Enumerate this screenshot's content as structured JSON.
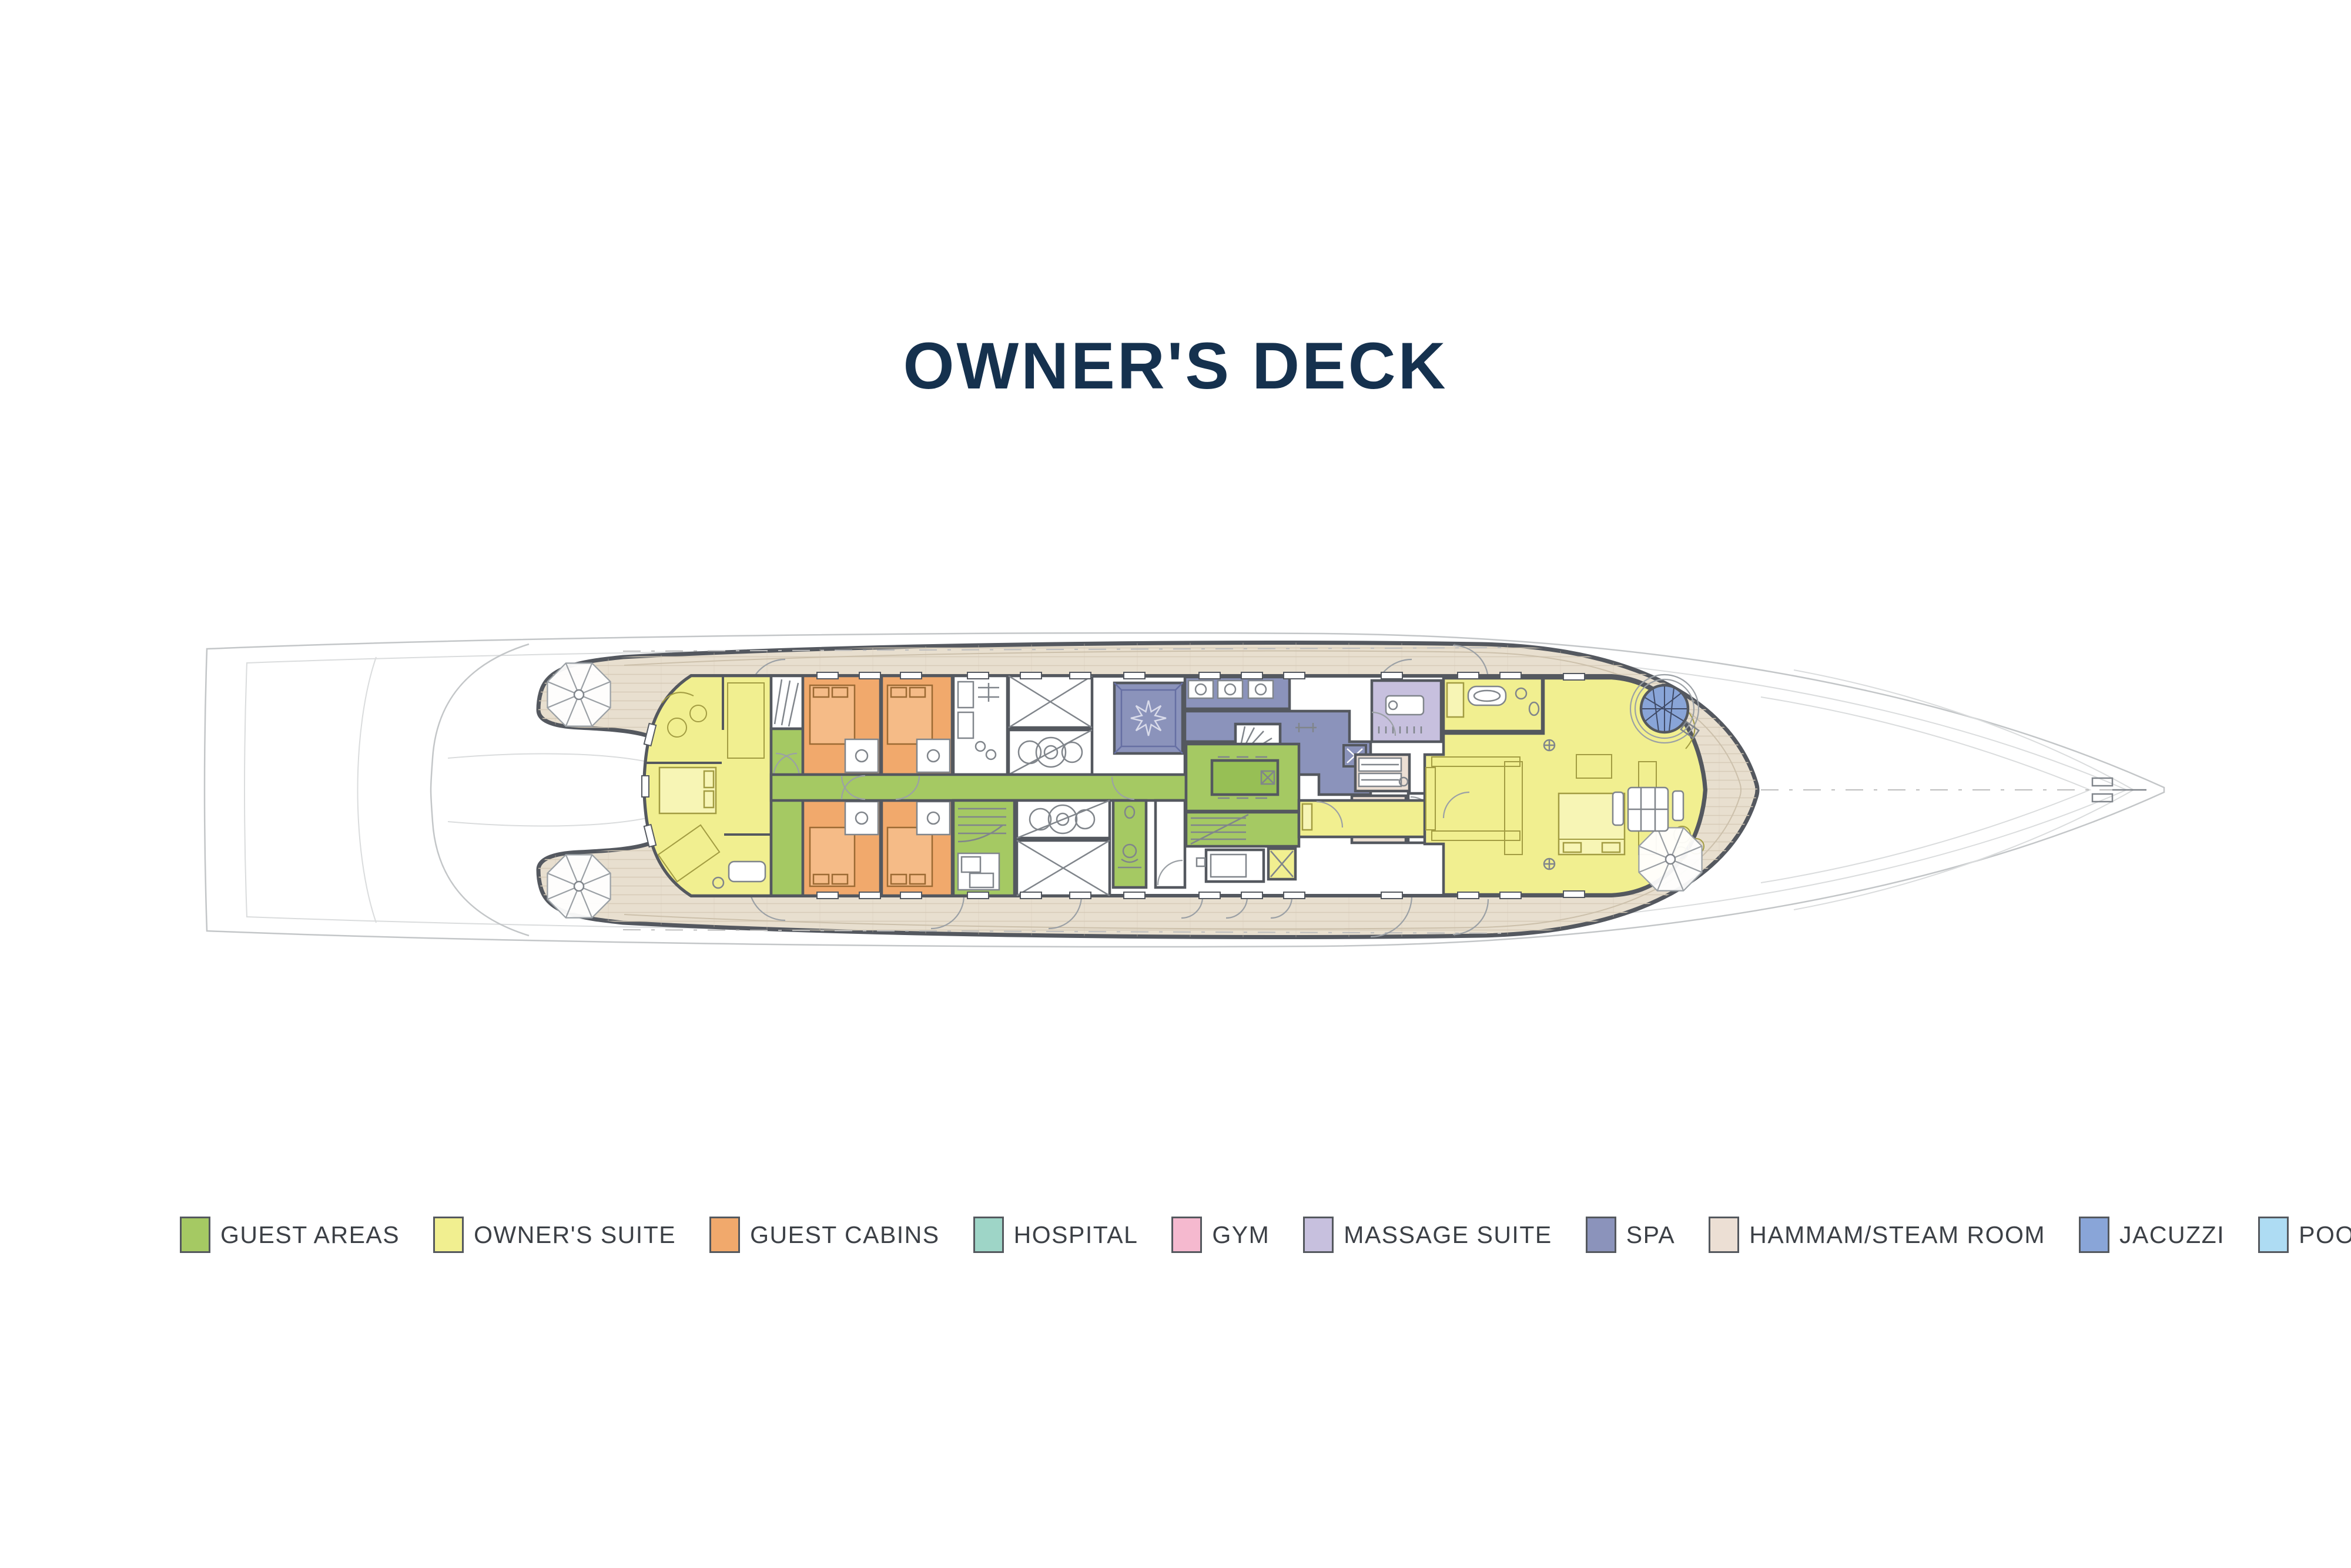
{
  "page": {
    "title": "OWNER'S DECK"
  },
  "ui_colors": {
    "title": "#15314E",
    "legend_text": "#3C4046",
    "swatch_border": "#54585E",
    "background": "#FFFFFF"
  },
  "legend": {
    "items": [
      {
        "key": "guest-areas",
        "label": "GUEST AREAS",
        "color": "#A5C963"
      },
      {
        "key": "owners-suite",
        "label": "OWNER'S SUITE",
        "color": "#F1EF90"
      },
      {
        "key": "guest-cabins",
        "label": "GUEST CABINS",
        "color": "#F1A96C"
      },
      {
        "key": "hospital",
        "label": "HOSPITAL",
        "color": "#9ED5C7"
      },
      {
        "key": "gym",
        "label": "GYM",
        "color": "#F5B9CF"
      },
      {
        "key": "massage-suite",
        "label": "MASSAGE SUITE",
        "color": "#C7C0DE"
      },
      {
        "key": "spa",
        "label": "SPA",
        "color": "#8B93BB"
      },
      {
        "key": "hammam-steam-room",
        "label": "HAMMAM/STEAM ROOM",
        "color": "#ECDFD4"
      },
      {
        "key": "jacuzzi",
        "label": "JACUZZI",
        "color": "#89A5D8"
      },
      {
        "key": "pool",
        "label": "POOL",
        "color": "#AEDCF3"
      }
    ]
  },
  "plan": {
    "colors": {
      "deck": "#E8DFCF",
      "plank": "#D6CBB8",
      "deck_trim": "#CCC0AB",
      "wall": "#54585F",
      "room": "#FFFFFF",
      "hull": "#C3C6C8",
      "hull_light": "#DADCDD",
      "furniture": "#80858B",
      "yellow_furniture": "#A29C42",
      "orange_furniture": "#9C6A33",
      "atrium_table": "#97BF55",
      "spa_inner": "#666FA3"
    },
    "icons": {
      "parasol": "octagon umbrella, top view",
      "jacuzzi": "round tub with lattice glazing"
    }
  }
}
